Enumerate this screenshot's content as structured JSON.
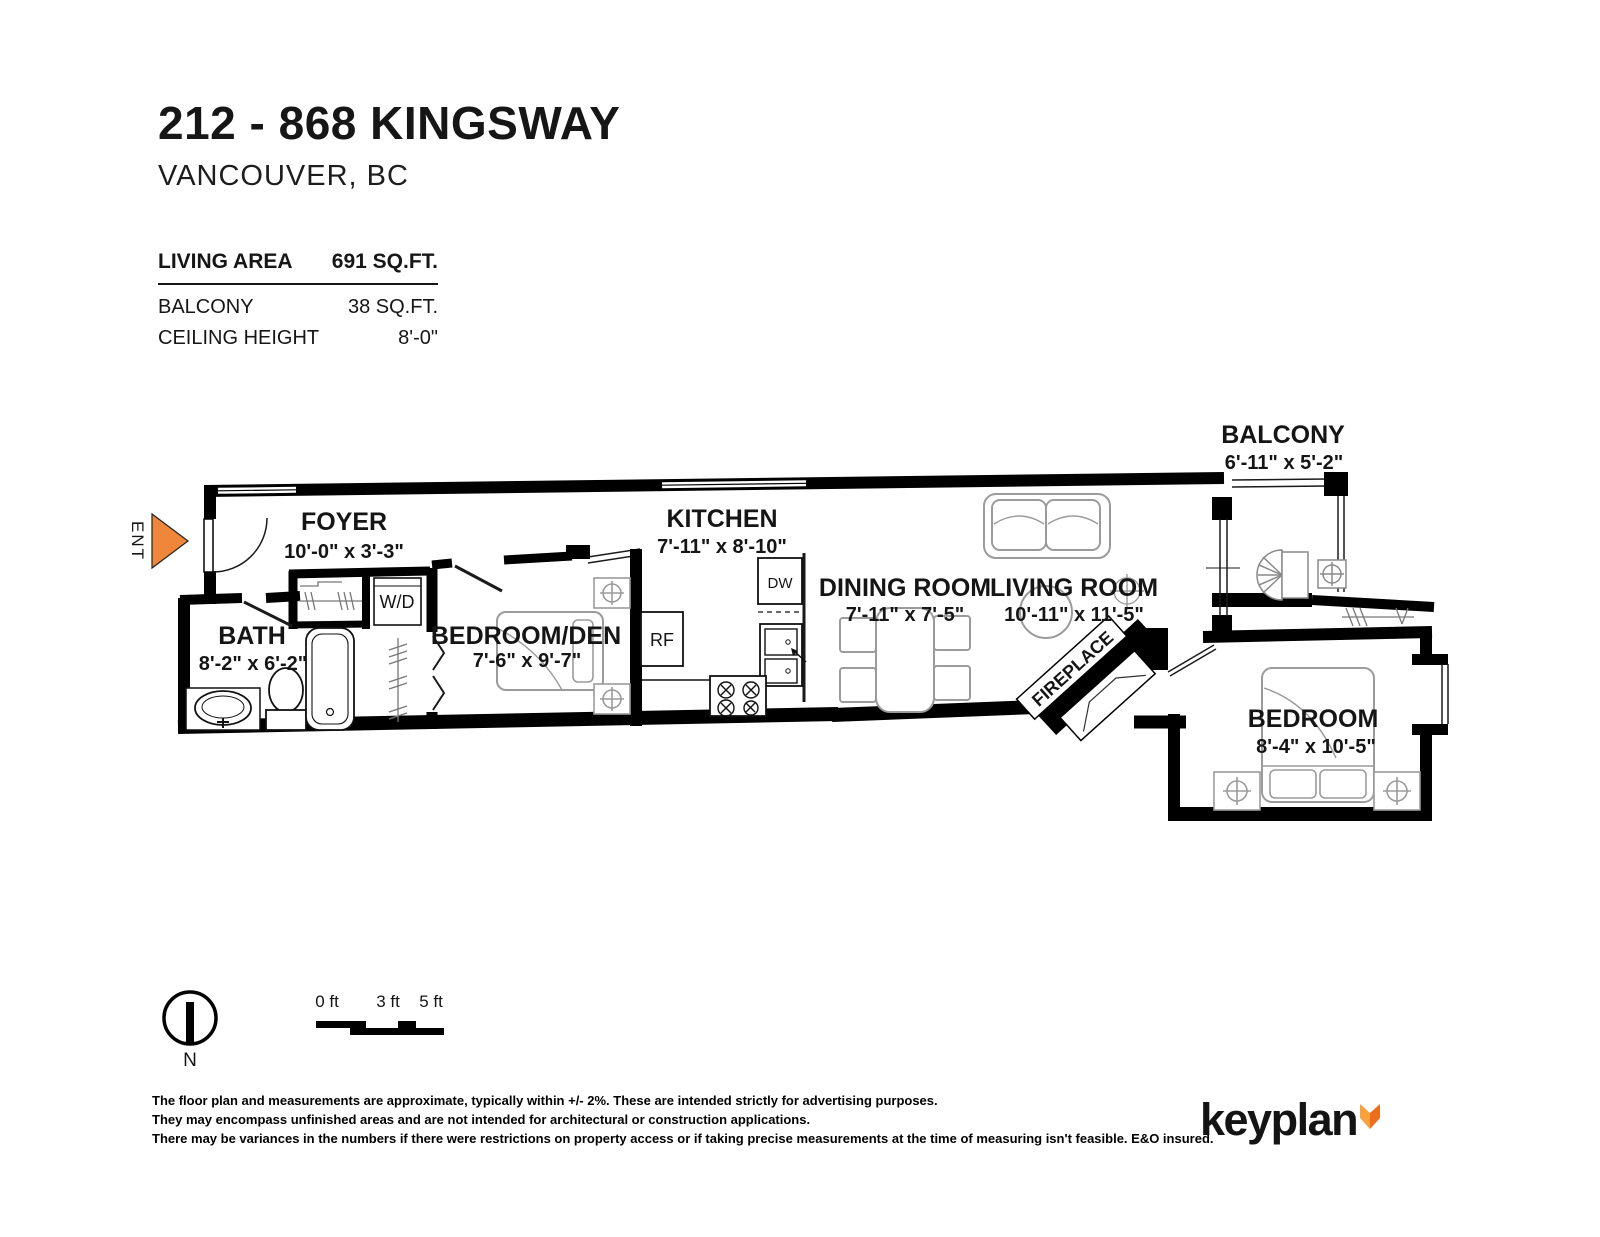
{
  "header": {
    "title": "212 - 868 KINGSWAY",
    "city": "VANCOUVER, BC"
  },
  "stats": {
    "rows": [
      {
        "label": "LIVING AREA",
        "value": "691 SQ.FT."
      },
      {
        "label": "BALCONY",
        "value": "38 SQ.FT."
      },
      {
        "label": "CEILING HEIGHT",
        "value": "8'-0\""
      }
    ]
  },
  "plan": {
    "entry_label": "ENT",
    "entry_arrow_color": "#F0863A",
    "labels": {
      "washer_dryer": "W/D",
      "fridge": "RF",
      "dishwasher": "DW",
      "fireplace": "FIREPLACE"
    },
    "rooms": [
      {
        "name": "BALCONY",
        "dims": "6'-11\" x 5'-2\""
      },
      {
        "name": "FOYER",
        "dims": "10'-0\" x 3'-3\""
      },
      {
        "name": "KITCHEN",
        "dims": "7'-11\" x 8'-10\""
      },
      {
        "name": "DINING ROOM",
        "dims": "7'-11\" x 7'-5\""
      },
      {
        "name": "LIVING ROOM",
        "dims": "10'-11\" x 11'-5\""
      },
      {
        "name": "BATH",
        "dims": "8'-2\" x 6'-2\""
      },
      {
        "name": "BEDROOM/DEN",
        "dims": "7'-6\" x 9'-7\""
      },
      {
        "name": "BEDROOM",
        "dims": "8'-4\" x 10'-5\""
      }
    ]
  },
  "legend": {
    "north_label": "N",
    "scale_ticks": [
      "0 ft",
      "3 ft",
      "5 ft"
    ]
  },
  "footer": {
    "disclaimer_lines": [
      "The floor plan and measurements are approximate, typically within +/- 2%. These are intended strictly for advertising purposes.",
      "They may encompass unfinished areas and are not intended for architectural or construction applications.",
      "There may be variances in the numbers if there were restrictions on property access or if taking precise measurements at the time of measuring isn't feasible. E&O insured."
    ],
    "brand": "keyplan",
    "fox_light": "#F9A13D",
    "fox_dark": "#EE6D1C"
  }
}
